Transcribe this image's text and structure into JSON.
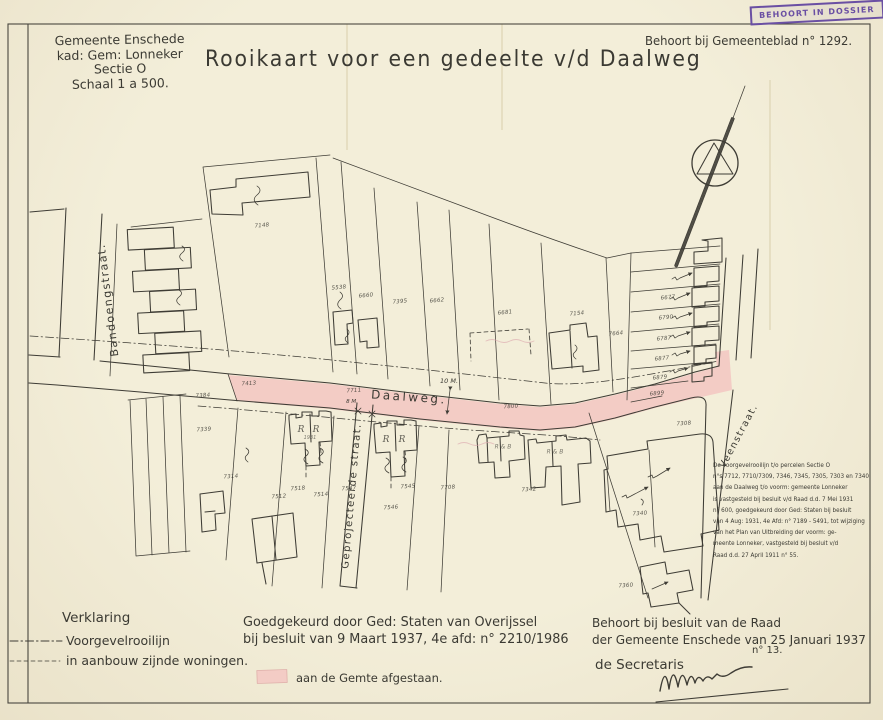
{
  "palette": {
    "paper": "#f0e9d2",
    "ink": "#3e3c35",
    "road_pink": "#f3ccc5",
    "stamp_purple": "#6a4fa3"
  },
  "header": {
    "corner_note": {
      "line1": "Gemeente Enschede",
      "line2": "kad: Gem: Lonneker",
      "line3": "Sectie O",
      "line4": "Schaal 1 a 500."
    },
    "title": "Rooikaart voor een gedeelte v/d Daalweg",
    "gemeenteblad": "Behoort bij Gemeenteblad n° 1292.",
    "stamp": "BEHOORT IN DOSSIER"
  },
  "map": {
    "labels": [
      {
        "text": "Bandoengstraat.",
        "x": 108,
        "y": 300,
        "rot": -97,
        "size": 11,
        "cls": "street",
        "name": "street-label-bandoengstraat"
      },
      {
        "text": "Daalweg.",
        "x": 409,
        "y": 397,
        "rot": 4,
        "size": 12,
        "ls": 2.5,
        "cls": "street",
        "name": "street-label-daalweg"
      },
      {
        "text": "Geprojecteerde straat.",
        "x": 352,
        "y": 496,
        "rot": -85,
        "size": 10,
        "cls": "street",
        "name": "street-label-geprojecteerde-straat"
      },
      {
        "text": "Veenstraat.",
        "x": 739,
        "y": 436,
        "rot": -62,
        "size": 9.5,
        "cls": "street",
        "name": "street-label-veenstraat"
      },
      {
        "text": "10 M.",
        "x": 449,
        "y": 381,
        "cls": "meas",
        "name": "road-width-measure"
      },
      {
        "text": "8 M.",
        "x": 352,
        "y": 402,
        "size": 5.5,
        "cls": "meas",
        "name": "street-width-measure"
      },
      {
        "text": "7148",
        "x": 262,
        "y": 226,
        "rot": -5,
        "cls": "parcel"
      },
      {
        "text": "5538",
        "x": 339,
        "y": 288,
        "rot": -5,
        "cls": "parcel"
      },
      {
        "text": "6660",
        "x": 366,
        "y": 296,
        "rot": -5,
        "cls": "parcel"
      },
      {
        "text": "7395",
        "x": 400,
        "y": 302,
        "rot": -5,
        "cls": "parcel"
      },
      {
        "text": "6662",
        "x": 437,
        "y": 301,
        "rot": -5,
        "cls": "parcel"
      },
      {
        "text": "6681",
        "x": 505,
        "y": 313,
        "rot": -5,
        "cls": "parcel"
      },
      {
        "text": "7154",
        "x": 577,
        "y": 314,
        "rot": -5,
        "cls": "parcel"
      },
      {
        "text": "7664",
        "x": 616,
        "y": 334,
        "rot": -5,
        "cls": "parcel"
      },
      {
        "text": "6677",
        "x": 668,
        "y": 298,
        "rot": -5,
        "cls": "parcel"
      },
      {
        "text": "6790",
        "x": 666,
        "y": 318,
        "rot": -5,
        "cls": "parcel"
      },
      {
        "text": "6787",
        "x": 664,
        "y": 339,
        "rot": -5,
        "cls": "parcel"
      },
      {
        "text": "6877",
        "x": 662,
        "y": 359,
        "rot": -5,
        "cls": "parcel"
      },
      {
        "text": "6879",
        "x": 660,
        "y": 378,
        "rot": -5,
        "cls": "parcel"
      },
      {
        "text": "6899",
        "x": 657,
        "y": 394,
        "rot": -5,
        "cls": "parcel"
      },
      {
        "text": "7413",
        "x": 249,
        "y": 384,
        "rot": -4,
        "cls": "parcel"
      },
      {
        "text": "7711",
        "x": 354,
        "y": 391,
        "rot": -4,
        "cls": "parcel"
      },
      {
        "text": "7800",
        "x": 511,
        "y": 407,
        "rot": -4,
        "cls": "parcel"
      },
      {
        "text": "7308",
        "x": 684,
        "y": 424,
        "rot": -4,
        "cls": "parcel"
      },
      {
        "text": "7384",
        "x": 203,
        "y": 396,
        "rot": -4,
        "cls": "parcel"
      },
      {
        "text": "7339",
        "x": 204,
        "y": 430,
        "rot": -4,
        "cls": "parcel"
      },
      {
        "text": "7314",
        "x": 231,
        "y": 477,
        "rot": -4,
        "cls": "parcel"
      },
      {
        "text": "7512",
        "x": 279,
        "y": 497,
        "rot": -4,
        "cls": "parcel"
      },
      {
        "text": "7518",
        "x": 298,
        "y": 489,
        "rot": -4,
        "cls": "parcel"
      },
      {
        "text": "7514",
        "x": 321,
        "y": 495,
        "rot": -4,
        "cls": "parcel"
      },
      {
        "text": "7547",
        "x": 349,
        "y": 489,
        "rot": -4,
        "cls": "parcel"
      },
      {
        "text": "7546",
        "x": 391,
        "y": 508,
        "rot": -4,
        "cls": "parcel"
      },
      {
        "text": "7545",
        "x": 408,
        "y": 487,
        "rot": -4,
        "cls": "parcel"
      },
      {
        "text": "7708",
        "x": 448,
        "y": 488,
        "rot": -4,
        "cls": "parcel"
      },
      {
        "text": "7342",
        "x": 529,
        "y": 490,
        "rot": -4,
        "cls": "parcel"
      },
      {
        "text": "7340",
        "x": 640,
        "y": 514,
        "rot": -4,
        "cls": "parcel"
      },
      {
        "text": "7360",
        "x": 626,
        "y": 586,
        "rot": -4,
        "cls": "parcel"
      },
      {
        "text": "R",
        "x": 301,
        "y": 430,
        "cls": "rmark"
      },
      {
        "text": "R",
        "x": 316,
        "y": 430,
        "cls": "rmark"
      },
      {
        "text": "R",
        "x": 386,
        "y": 440,
        "cls": "rmark"
      },
      {
        "text": "R",
        "x": 402,
        "y": 440,
        "cls": "rmark"
      },
      {
        "text": "R & B",
        "x": 503,
        "y": 447,
        "size": 6,
        "cls": "faint"
      },
      {
        "text": "R & B",
        "x": 555,
        "y": 452,
        "size": 6,
        "cls": "faint"
      },
      {
        "text": "1931",
        "x": 310,
        "y": 438,
        "size": 5,
        "cls": "faint"
      }
    ]
  },
  "notes": {
    "rooilijn_note": {
      "lines": [
        "De voorgevelrooilijn t/o percelen Sectie O",
        "n°s 7712, 7710/7309,  7346, 7345, 7305, 7303 en 7340",
        "aan de Daalweg t/o voorm: gemeente Lonneker",
        "is vastgesteld bij besluit v/d Raad d.d. 7 Mei 1931",
        "n° 600, goedgekeurd door Ged: Staten bij besluit",
        "van 4 Aug: 1931, 4e Afd: n° 7189 - 5491, tot wijziging",
        "van het Plan van Uitbreiding der voorm: ge-",
        "meente Lonneker, vastgesteld bij besluit v/d",
        "Raad d.d. 27 April 1911 n° 55."
      ]
    }
  },
  "legend": {
    "title": "Verklaring",
    "items": [
      {
        "label": "Voorgevelrooilijn",
        "line_style": "dash-dot"
      },
      {
        "label": "in aanbouw zijnde woningen.",
        "line_style": "dashed"
      }
    ]
  },
  "approval": {
    "line1": "Goedgekeurd door Ged: Staten van Overijssel",
    "line2": "bij besluit van  9 Maart 1937, 4e afd: n° 2210/1986"
  },
  "ceded": {
    "label": "aan de Gemte afgestaan."
  },
  "council": {
    "line1": "Behoort bij besluit van de Raad",
    "line2": "der Gemeente Enschede van 25 Januari 1937",
    "number": "n° 13.",
    "signer": "de Secretaris"
  }
}
